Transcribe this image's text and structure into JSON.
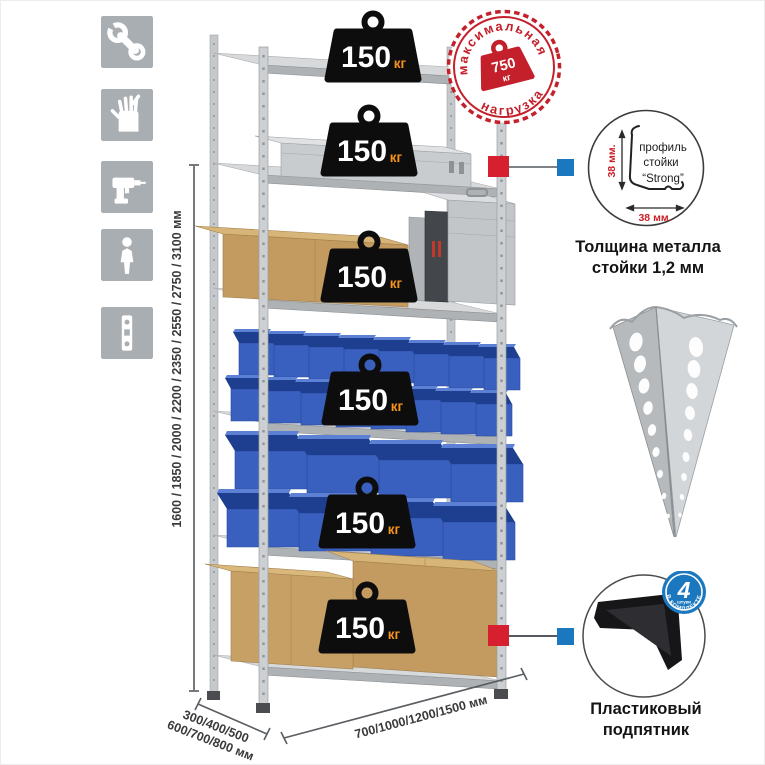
{
  "sidebar": {
    "icons": [
      {
        "name": "wrench-icon"
      },
      {
        "name": "gloves-icon"
      },
      {
        "name": "drill-icon"
      },
      {
        "name": "person-icon"
      },
      {
        "name": "perforated-profile-icon"
      }
    ]
  },
  "dimensions": {
    "height": "1600 / 1850 / 2000 / 2200 / 2350 / 2550 / 2750 / 3100 мм",
    "depth_line1": "300/400/500",
    "depth_line2": "600/700/800 мм",
    "width": "700/1000/1200/1500 мм"
  },
  "rack": {
    "shelf_count": 6,
    "load_value": "150",
    "load_unit": "кг"
  },
  "stamp": {
    "arc_top": "максимальная",
    "arc_bottom": "нагрузка",
    "value": "750",
    "unit": "кг"
  },
  "profile_detail": {
    "dim_vertical": "38 мм.",
    "dim_horizontal": "38 мм.",
    "label_line1": "профиль",
    "label_line2": "стойки",
    "label_line3": "“Strong”",
    "caption_line1": "Толщина металла",
    "caption_line2": "стойки 1,2 мм"
  },
  "foot_detail": {
    "badge_value": "4",
    "badge_word": "штуки",
    "badge_arc": "в комплекте",
    "caption_line1": "Пластиковый",
    "caption_line2": "подпятник"
  },
  "colors": {
    "accent_red": "#d6202f",
    "stamp_red": "#c4202b",
    "accent_blue": "#1b78be",
    "bin_blue": "#3a60bf",
    "bin_dark_blue": "#1e3f8f",
    "weight_black": "#0d0d0d",
    "unit_orange": "#f7941d",
    "metal_gray": "#ced1d3",
    "icon_gray": "#a9aeb3",
    "cardboard": "#c39a60"
  }
}
